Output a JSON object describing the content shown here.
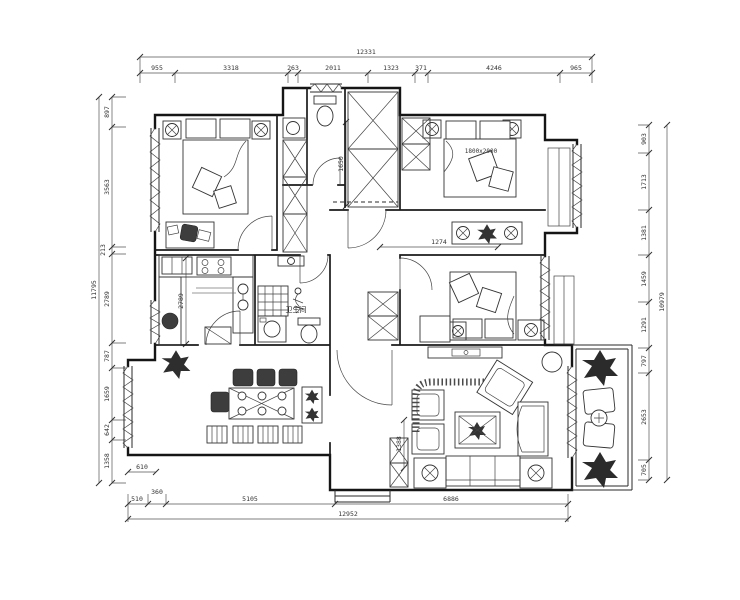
{
  "dims": {
    "top": {
      "total": "12331",
      "segments": [
        "955",
        "3318",
        "263",
        "2011",
        "1323",
        "371",
        "4246",
        "965"
      ]
    },
    "bottom": {
      "total": "12952",
      "segments": [
        "510",
        "360",
        "5105",
        "6886"
      ]
    },
    "left": {
      "total": "11795",
      "segments": [
        "897",
        "3563",
        "213",
        "2789",
        "787",
        "1659",
        "642",
        "1358"
      ]
    },
    "right": {
      "total": "10979",
      "segments": [
        "903",
        "1713",
        "1381",
        "1459",
        "1291",
        "797",
        "2653",
        "705"
      ]
    },
    "inner": {
      "kitchen_height": "2789",
      "closet_height": "1650",
      "corridor_width": "1274",
      "living_height": "1388",
      "bay_width": "610"
    }
  },
  "labels": {
    "bathroom": "卫生间",
    "bed_size": "1800x2000"
  }
}
